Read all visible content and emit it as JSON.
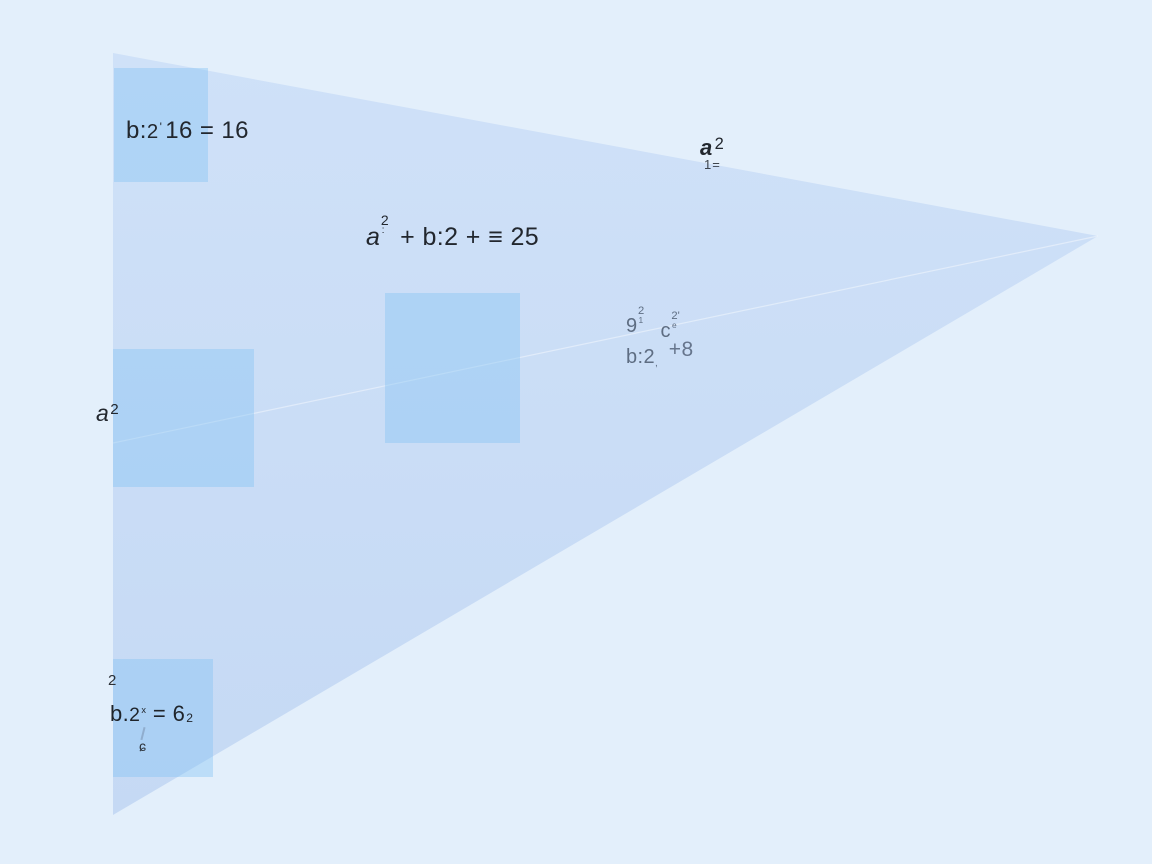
{
  "scene": {
    "background_color": "#e3effb",
    "triangle_fill_top": "#cfe1f8",
    "triangle_fill_bottom": "#c5d9f4",
    "square_fill": "#85c3f2",
    "seam_stroke": "rgba(255,255,255,0.42)",
    "text_color": "#22272e",
    "muted_text_color": "#5e6d82"
  },
  "triangle": {
    "points": "113,53 1098,236 113,815"
  },
  "seam_line": {
    "x1": "113",
    "y1": "443",
    "x2": "1098",
    "y2": "236"
  },
  "squares": [
    {
      "x": "114",
      "y": "68",
      "w": "94",
      "h": "114"
    },
    {
      "x": "385",
      "y": "293",
      "w": "135",
      "h": "150"
    },
    {
      "x": "113",
      "y": "349",
      "w": "141",
      "h": "138"
    },
    {
      "x": "113",
      "y": "659",
      "w": "100",
      "h": "118"
    }
  ],
  "labels": {
    "top_left": {
      "pre": "b:",
      "two": "2",
      "tick": "'",
      "rest": "16 = 16"
    },
    "center": {
      "base": "a",
      "sup": "2",
      "sub": ":",
      "rest": " + b:2 + ≡ 25"
    },
    "apex": {
      "base": "a",
      "sup": "2",
      "below": "1="
    },
    "mid": {
      "first_base": "9",
      "first_sup": "2",
      "first_sub": "1",
      "second_base": "c",
      "second_sup": "2'",
      "second_sub": "e",
      "l2_pre": "b:",
      "l2_two": "2",
      "l2_sub": ",",
      "l2_plus": "+8"
    },
    "left": {
      "base": "a",
      "sup": "2"
    },
    "bottom": {
      "small_top": "2",
      "pre": "b.",
      "two": "2",
      "sup": "x",
      "rest": " = 6",
      "sub": "2",
      "small_below": "ɕ"
    }
  }
}
